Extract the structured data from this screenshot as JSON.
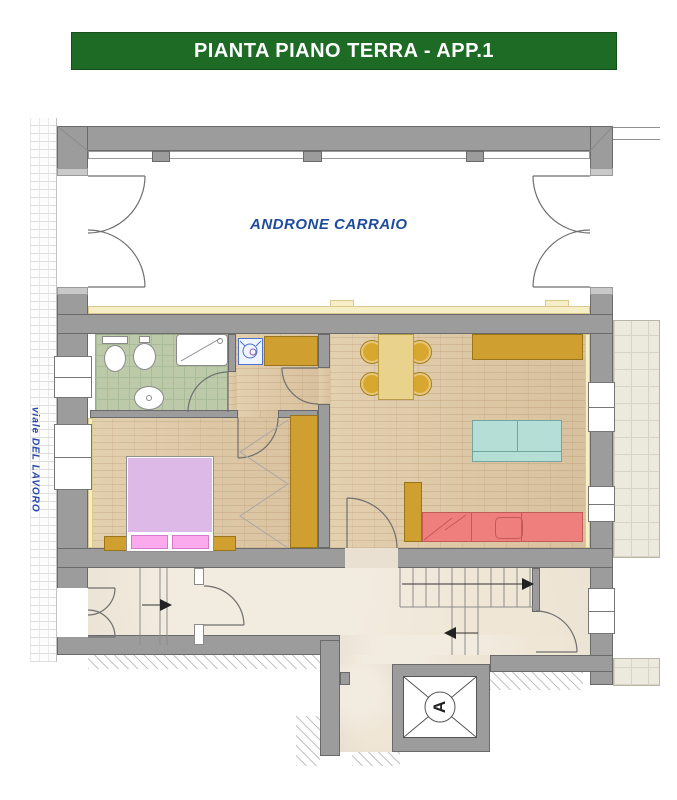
{
  "header": {
    "title": "PIANTA PIANO TERRA - APP.1"
  },
  "plan": {
    "hall_label": "ANDRONE CARRAIO",
    "street_label": "viale DEL LAVORO",
    "elevator_label": "A"
  },
  "palette": {
    "header_green": "#1e6b26",
    "wall_gray": "#9c9c9c",
    "hall_label_blue": "#1d4b9e",
    "street_label_blue": "#2746ad",
    "bathroom_tile_green": "#bccaa9",
    "parquet_wood": "#ddc8a7",
    "furniture_mustard": "#cfa02f",
    "bed_lilac": "#dcb9e6",
    "pillow_pink": "#fbaaee",
    "sofa_teal": "#b5ded7",
    "kitchen_counter_red": "#ef7f7c",
    "corridor_marble_beige": "#e9e0d1",
    "insulation_cream": "#f6eec6"
  },
  "icons": {
    "stair_arrow_right": "▶",
    "stair_arrow_left": "◀"
  }
}
